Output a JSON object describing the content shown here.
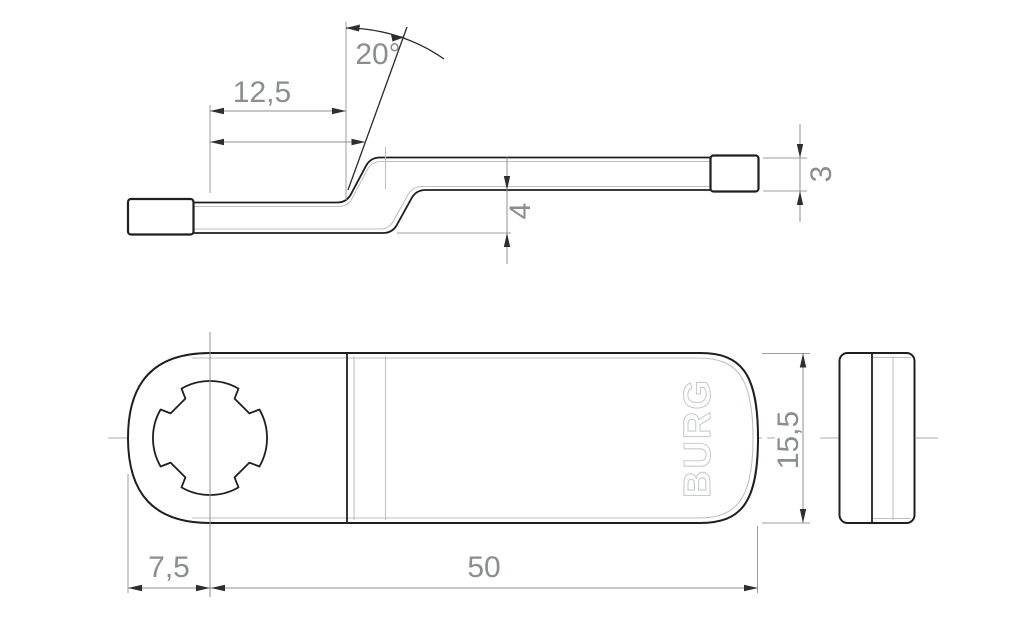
{
  "drawing": {
    "kind": "technical-dimension-drawing",
    "part": "flat offset lock cam with cross-shaped spindle hole"
  },
  "logo": {
    "text": "BURG"
  },
  "dimensions": {
    "offset_length": "12,5",
    "bend_angle": "20°",
    "step_height": "4",
    "material_thickness": "3",
    "end_to_hole_center": "7,5",
    "hole_center_to_tip": "50",
    "body_width": "15,5"
  },
  "colors": {
    "outline": "#1f1f1f",
    "dimension_gray": "#8c9090",
    "thin_light": "#bcc2c2",
    "logo_outline": "#c9cccc",
    "background": "#ffffff"
  }
}
